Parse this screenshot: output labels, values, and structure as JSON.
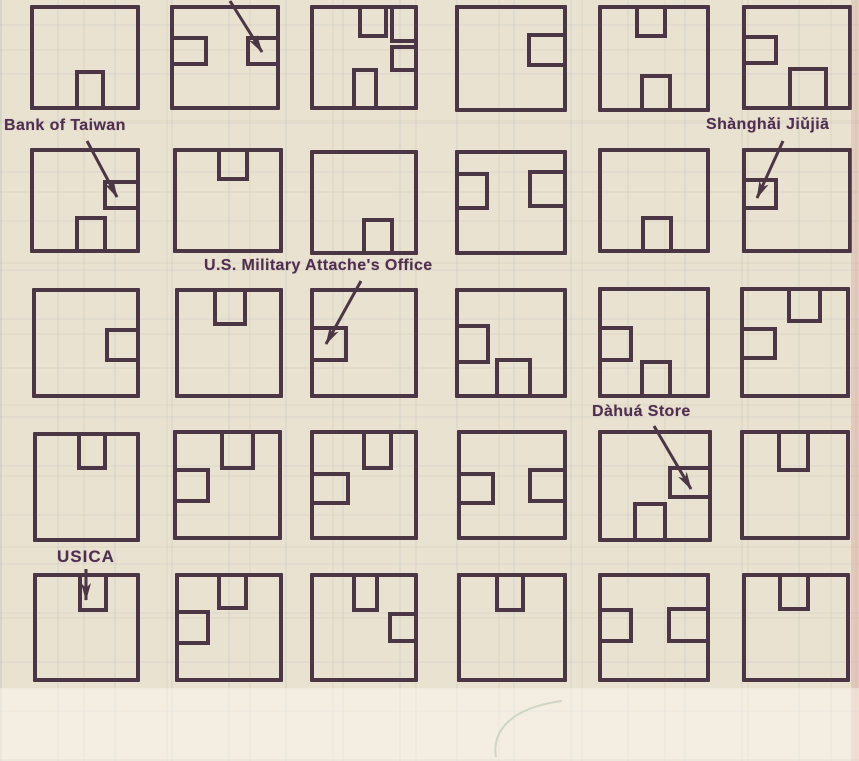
{
  "colors": {
    "ink": "#4a3644",
    "label_ink": "#4f2e50",
    "paper": "#eae2d0",
    "pen_mark": "#9dab92"
  },
  "map": {
    "description": "scanned street-map grid of 30 city blocks with buildings",
    "annotations": [
      {
        "id": "bank-of-taiwan",
        "text": "Bank of Taiwan",
        "label_x": 4,
        "label_y": 117,
        "arrow": {
          "x1": 87,
          "y1": 141,
          "x2": 117,
          "y2": 197
        }
      },
      {
        "id": "shanghai-jiujia",
        "text": "Shànghǎi Jiǔjiā",
        "label_x": 706,
        "label_y": 116,
        "arrow": {
          "x1": 783,
          "y1": 141,
          "x2": 757,
          "y2": 198
        }
      },
      {
        "id": "us-military-attaches-office",
        "text": "U.S. Military Attache's Office",
        "label_x": 204,
        "label_y": 257,
        "arrow": {
          "x1": 361,
          "y1": 281,
          "x2": 326,
          "y2": 344
        }
      },
      {
        "id": "dahua-store",
        "text": "Dàhuá Store",
        "label_x": 592,
        "label_y": 403,
        "arrow": {
          "x1": 654,
          "y1": 426,
          "x2": 691,
          "y2": 489
        }
      },
      {
        "id": "usica",
        "text": "USICA",
        "label_x": 57,
        "label_y": 547,
        "arrow": {
          "x1": 86,
          "y1": 569,
          "x2": 86,
          "y2": 600
        }
      },
      {
        "id": "cut-off-label",
        "text": "",
        "arrow": {
          "x1": 230,
          "y1": 1,
          "x2": 262,
          "y2": 52
        }
      }
    ],
    "blocks": [
      {
        "row": 1,
        "col": 1,
        "x": 30,
        "y": 5,
        "w": 110,
        "h": 105,
        "buildings": [
          {
            "x": 75,
            "y": 70,
            "w": 30,
            "h": 40,
            "open": "bottom"
          }
        ]
      },
      {
        "row": 1,
        "col": 2,
        "x": 170,
        "y": 5,
        "w": 110,
        "h": 105,
        "buildings": [
          {
            "x": 170,
            "y": 36,
            "w": 38,
            "h": 30,
            "open": "left"
          },
          {
            "x": 246,
            "y": 36,
            "w": 34,
            "h": 30,
            "open": "right",
            "name": "unlabeled-arrow-target"
          }
        ]
      },
      {
        "row": 1,
        "col": 3,
        "x": 310,
        "y": 5,
        "w": 108,
        "h": 105,
        "buildings": [
          {
            "x": 358,
            "y": 5,
            "w": 30,
            "h": 33,
            "open": "top"
          },
          {
            "x": 390,
            "y": 5,
            "w": 28,
            "h": 38,
            "open": [
              "top",
              "right"
            ]
          },
          {
            "x": 390,
            "y": 45,
            "w": 28,
            "h": 27,
            "open": "right"
          },
          {
            "x": 352,
            "y": 68,
            "w": 26,
            "h": 42,
            "open": "bottom"
          }
        ]
      },
      {
        "row": 1,
        "col": 4,
        "x": 455,
        "y": 5,
        "w": 112,
        "h": 107,
        "buildings": [
          {
            "x": 527,
            "y": 33,
            "w": 40,
            "h": 34,
            "open": "right"
          }
        ]
      },
      {
        "row": 1,
        "col": 5,
        "x": 598,
        "y": 5,
        "w": 112,
        "h": 107,
        "buildings": [
          {
            "x": 635,
            "y": 5,
            "w": 32,
            "h": 33,
            "open": "top"
          },
          {
            "x": 640,
            "y": 74,
            "w": 32,
            "h": 38,
            "open": "bottom"
          }
        ]
      },
      {
        "row": 1,
        "col": 6,
        "x": 742,
        "y": 5,
        "w": 110,
        "h": 105,
        "buildings": [
          {
            "x": 742,
            "y": 35,
            "w": 36,
            "h": 30,
            "open": "left"
          },
          {
            "x": 788,
            "y": 67,
            "w": 40,
            "h": 43,
            "open": "bottom"
          }
        ]
      },
      {
        "row": 2,
        "col": 1,
        "x": 30,
        "y": 148,
        "w": 110,
        "h": 105,
        "buildings": [
          {
            "x": 103,
            "y": 180,
            "w": 37,
            "h": 30,
            "open": "right",
            "name": "bank-of-taiwan-building"
          },
          {
            "x": 75,
            "y": 216,
            "w": 32,
            "h": 37,
            "open": "bottom"
          }
        ]
      },
      {
        "row": 2,
        "col": 2,
        "x": 173,
        "y": 148,
        "w": 110,
        "h": 105,
        "buildings": [
          {
            "x": 217,
            "y": 148,
            "w": 32,
            "h": 33,
            "open": "top"
          }
        ]
      },
      {
        "row": 2,
        "col": 3,
        "x": 310,
        "y": 150,
        "w": 108,
        "h": 105,
        "buildings": [
          {
            "x": 362,
            "y": 218,
            "w": 32,
            "h": 37,
            "open": "bottom"
          }
        ]
      },
      {
        "row": 2,
        "col": 4,
        "x": 455,
        "y": 150,
        "w": 112,
        "h": 105,
        "buildings": [
          {
            "x": 455,
            "y": 172,
            "w": 34,
            "h": 38,
            "open": "left"
          },
          {
            "x": 528,
            "y": 170,
            "w": 39,
            "h": 38,
            "open": "right"
          }
        ]
      },
      {
        "row": 2,
        "col": 5,
        "x": 598,
        "y": 148,
        "w": 112,
        "h": 105,
        "buildings": [
          {
            "x": 641,
            "y": 216,
            "w": 32,
            "h": 37,
            "open": "bottom"
          }
        ]
      },
      {
        "row": 2,
        "col": 6,
        "x": 742,
        "y": 148,
        "w": 110,
        "h": 105,
        "buildings": [
          {
            "x": 742,
            "y": 178,
            "w": 36,
            "h": 32,
            "open": "left",
            "name": "shanghai-jiujia-building"
          }
        ]
      },
      {
        "row": 3,
        "col": 1,
        "x": 32,
        "y": 288,
        "w": 108,
        "h": 110,
        "buildings": [
          {
            "x": 105,
            "y": 328,
            "w": 35,
            "h": 34,
            "open": "right"
          }
        ]
      },
      {
        "row": 3,
        "col": 2,
        "x": 175,
        "y": 288,
        "w": 108,
        "h": 110,
        "buildings": [
          {
            "x": 213,
            "y": 288,
            "w": 34,
            "h": 38,
            "open": "top"
          }
        ]
      },
      {
        "row": 3,
        "col": 3,
        "x": 310,
        "y": 288,
        "w": 108,
        "h": 110,
        "buildings": [
          {
            "x": 310,
            "y": 326,
            "w": 38,
            "h": 36,
            "open": "left",
            "name": "us-military-attaches-office-building"
          }
        ]
      },
      {
        "row": 3,
        "col": 4,
        "x": 455,
        "y": 288,
        "w": 112,
        "h": 110,
        "buildings": [
          {
            "x": 455,
            "y": 324,
            "w": 35,
            "h": 40,
            "open": "left"
          },
          {
            "x": 495,
            "y": 358,
            "w": 37,
            "h": 40,
            "open": "bottom"
          }
        ]
      },
      {
        "row": 3,
        "col": 5,
        "x": 598,
        "y": 287,
        "w": 112,
        "h": 111,
        "buildings": [
          {
            "x": 598,
            "y": 326,
            "w": 35,
            "h": 36,
            "open": "left"
          },
          {
            "x": 640,
            "y": 360,
            "w": 32,
            "h": 38,
            "open": "bottom"
          }
        ]
      },
      {
        "row": 3,
        "col": 6,
        "x": 740,
        "y": 287,
        "w": 110,
        "h": 111,
        "buildings": [
          {
            "x": 787,
            "y": 287,
            "w": 35,
            "h": 36,
            "open": "top"
          },
          {
            "x": 740,
            "y": 327,
            "w": 37,
            "h": 33,
            "open": "left"
          }
        ]
      },
      {
        "row": 4,
        "col": 1,
        "x": 33,
        "y": 432,
        "w": 107,
        "h": 110,
        "buildings": [
          {
            "x": 77,
            "y": 432,
            "w": 30,
            "h": 38,
            "open": "top"
          }
        ]
      },
      {
        "row": 4,
        "col": 2,
        "x": 173,
        "y": 430,
        "w": 109,
        "h": 110,
        "buildings": [
          {
            "x": 220,
            "y": 430,
            "w": 35,
            "h": 40,
            "open": "top"
          },
          {
            "x": 173,
            "y": 468,
            "w": 37,
            "h": 35,
            "open": "left"
          }
        ]
      },
      {
        "row": 4,
        "col": 3,
        "x": 310,
        "y": 430,
        "w": 108,
        "h": 110,
        "buildings": [
          {
            "x": 362,
            "y": 430,
            "w": 31,
            "h": 40,
            "open": "top"
          },
          {
            "x": 310,
            "y": 472,
            "w": 40,
            "h": 33,
            "open": "left"
          }
        ]
      },
      {
        "row": 4,
        "col": 4,
        "x": 457,
        "y": 430,
        "w": 110,
        "h": 110,
        "buildings": [
          {
            "x": 457,
            "y": 472,
            "w": 38,
            "h": 33,
            "open": "left"
          },
          {
            "x": 528,
            "y": 468,
            "w": 39,
            "h": 35,
            "open": "right"
          }
        ]
      },
      {
        "row": 4,
        "col": 5,
        "x": 598,
        "y": 430,
        "w": 114,
        "h": 112,
        "buildings": [
          {
            "x": 668,
            "y": 466,
            "w": 44,
            "h": 33,
            "open": "right",
            "name": "dahua-store-building"
          },
          {
            "x": 633,
            "y": 502,
            "w": 34,
            "h": 40,
            "open": "bottom"
          }
        ]
      },
      {
        "row": 4,
        "col": 6,
        "x": 740,
        "y": 430,
        "w": 110,
        "h": 110,
        "buildings": [
          {
            "x": 777,
            "y": 430,
            "w": 33,
            "h": 42,
            "open": "top"
          }
        ]
      },
      {
        "row": 5,
        "col": 1,
        "x": 33,
        "y": 573,
        "w": 107,
        "h": 109,
        "buildings": [
          {
            "x": 78,
            "y": 573,
            "w": 30,
            "h": 39,
            "open": "top",
            "name": "usica-building"
          }
        ]
      },
      {
        "row": 5,
        "col": 2,
        "x": 175,
        "y": 573,
        "w": 108,
        "h": 109,
        "buildings": [
          {
            "x": 217,
            "y": 573,
            "w": 31,
            "h": 37,
            "open": "top"
          },
          {
            "x": 175,
            "y": 610,
            "w": 35,
            "h": 35,
            "open": "left"
          }
        ]
      },
      {
        "row": 5,
        "col": 3,
        "x": 310,
        "y": 573,
        "w": 108,
        "h": 109,
        "buildings": [
          {
            "x": 352,
            "y": 573,
            "w": 27,
            "h": 39,
            "open": "top"
          },
          {
            "x": 388,
            "y": 612,
            "w": 30,
            "h": 31,
            "open": "right"
          }
        ]
      },
      {
        "row": 5,
        "col": 4,
        "x": 457,
        "y": 573,
        "w": 110,
        "h": 109,
        "buildings": [
          {
            "x": 495,
            "y": 573,
            "w": 30,
            "h": 39,
            "open": "top"
          }
        ]
      },
      {
        "row": 5,
        "col": 5,
        "x": 598,
        "y": 573,
        "w": 112,
        "h": 109,
        "buildings": [
          {
            "x": 598,
            "y": 608,
            "w": 35,
            "h": 35,
            "open": "left"
          },
          {
            "x": 667,
            "y": 607,
            "w": 43,
            "h": 36,
            "open": "right"
          }
        ]
      },
      {
        "row": 5,
        "col": 6,
        "x": 742,
        "y": 573,
        "w": 108,
        "h": 109,
        "buildings": [
          {
            "x": 778,
            "y": 573,
            "w": 32,
            "h": 38,
            "open": "top"
          }
        ]
      }
    ],
    "pen_mark": {
      "present": true,
      "color": "#9dab92"
    }
  }
}
